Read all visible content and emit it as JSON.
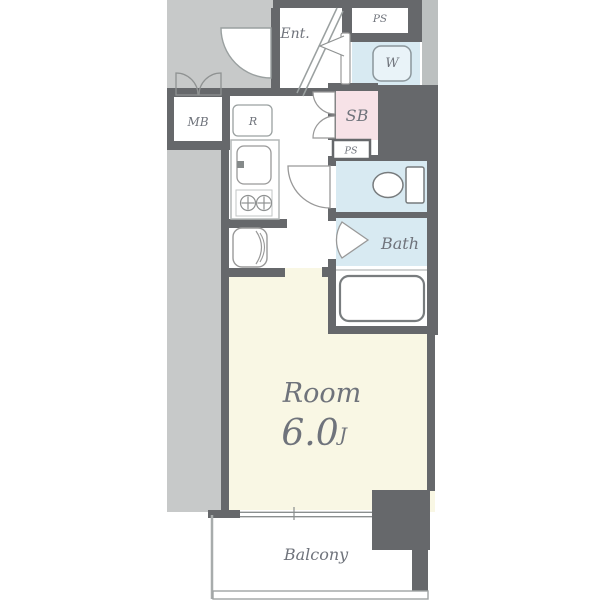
{
  "floor_plan": {
    "labels": {
      "ent": "Ent.",
      "ps_top": "PS",
      "washer": "W",
      "mb": "MB",
      "r": "R",
      "sb": "SB",
      "ps_small": "PS",
      "bath": "Bath",
      "room": "Room",
      "area_value": "6.0",
      "area_unit": "J",
      "balcony": "Balcony"
    },
    "colors": {
      "wall_dark_gray": "#66686b",
      "corridor_gray": "#c7c9c9",
      "shaft_gray": "#bcc0c0",
      "wet_area_blue": "#d8eaf2",
      "shoe_box_pink": "#f7e2e7",
      "room_cream": "#f9f7e4",
      "label_gray": "#6f737b",
      "fixture_line_gray": "#9aa0a0"
    },
    "fixtures": [
      "entrance-door-swing",
      "entrance-step-lines",
      "meter-box-double-doors",
      "washer-closet-folding-door",
      "refrigerator-space",
      "kitchen-sink",
      "gas-stove-two-burners",
      "vanity-basin",
      "toilet",
      "toilet-door-swing",
      "bath-folding-door",
      "bathtub",
      "sliding-window",
      "balcony-railing"
    ]
  }
}
